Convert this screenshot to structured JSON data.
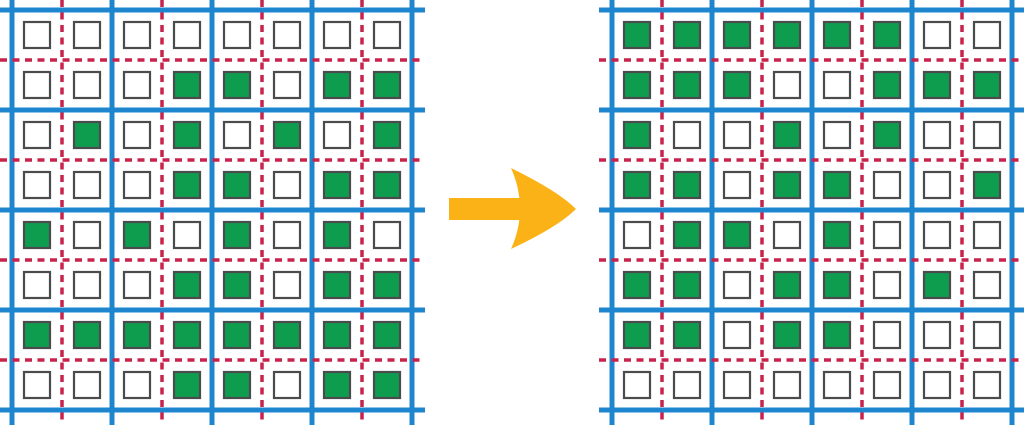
{
  "figure": {
    "type": "grid_transformation",
    "arrow": {
      "direction": "right",
      "color": "#FBB216"
    },
    "colors": {
      "major_grid_line": "#1E86CE",
      "minor_grid_line": "#C8234C",
      "filled_cell": "#0E9C4F",
      "empty_cell": "#FFFFFF",
      "cell_outline": "#4A4B4D",
      "background": "#FFFFFF"
    },
    "left_grid": {
      "rows": 8,
      "cols": 8,
      "cells": [
        [
          0,
          0,
          0,
          0,
          0,
          0,
          0,
          0
        ],
        [
          0,
          0,
          0,
          1,
          1,
          0,
          1,
          1
        ],
        [
          0,
          1,
          0,
          1,
          0,
          1,
          0,
          1
        ],
        [
          0,
          0,
          0,
          1,
          1,
          0,
          1,
          1
        ],
        [
          1,
          0,
          1,
          0,
          1,
          0,
          1,
          0
        ],
        [
          0,
          0,
          0,
          1,
          1,
          0,
          1,
          1
        ],
        [
          1,
          1,
          1,
          1,
          1,
          1,
          1,
          1
        ],
        [
          0,
          0,
          0,
          1,
          1,
          0,
          1,
          1
        ]
      ]
    },
    "right_grid": {
      "rows": 8,
      "cols": 8,
      "cells": [
        [
          1,
          1,
          1,
          1,
          1,
          1,
          0,
          0
        ],
        [
          1,
          1,
          1,
          0,
          0,
          1,
          1,
          1
        ],
        [
          1,
          0,
          0,
          1,
          0,
          1,
          0,
          0
        ],
        [
          1,
          1,
          0,
          1,
          1,
          0,
          0,
          1
        ],
        [
          0,
          1,
          1,
          0,
          1,
          0,
          0,
          0
        ],
        [
          1,
          1,
          0,
          1,
          1,
          0,
          1,
          0
        ],
        [
          1,
          1,
          0,
          1,
          1,
          0,
          0,
          0
        ],
        [
          0,
          0,
          0,
          0,
          0,
          0,
          0,
          0
        ]
      ]
    }
  }
}
